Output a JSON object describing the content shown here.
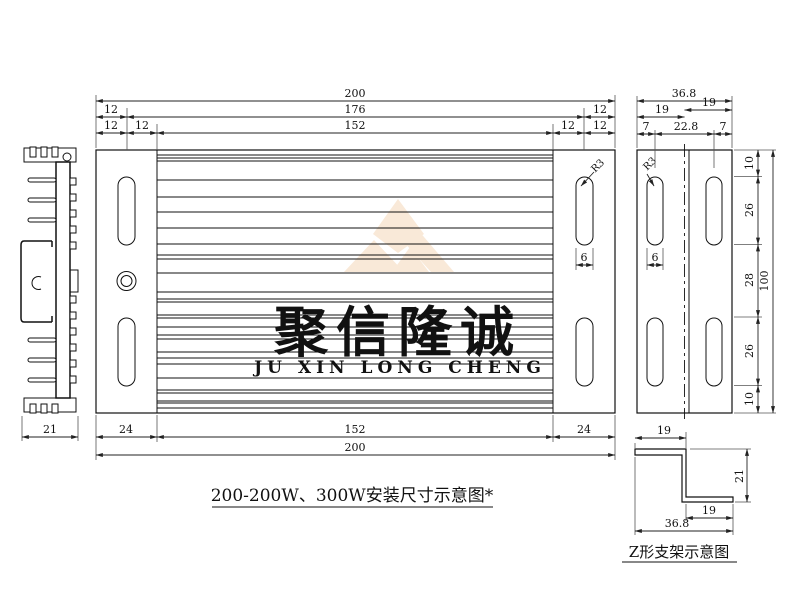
{
  "watermark": {
    "cn": "聚信隆诚",
    "en": "JU XIN LONG CHENG",
    "logo_color": "#f9e9d8",
    "cn_color": "#e3e3e3",
    "en_color": "#f7dcba"
  },
  "captions": {
    "main_title": "200-200W、300W安装尺寸示意图*",
    "bracket_title": "Z形支架示意图"
  },
  "main_view": {
    "dim_overall": "200",
    "dim_inner": "176",
    "dim_slot_span": "152",
    "dim_offset": "12",
    "dim_flange": "24",
    "slot_width": "6",
    "fillet_radius": "R3"
  },
  "side_view": {
    "dim_overall": "36.8",
    "dim_flange_left": "19",
    "dim_flange_right": "19",
    "dim_edge_left": "7",
    "dim_center": "22.8",
    "dim_edge_right": "7",
    "dim_top": "10",
    "dim_upper": "26",
    "dim_middle": "28",
    "dim_lower": "26",
    "dim_bottom": "10",
    "dim_height": "100",
    "slot_width": "6",
    "fillet_radius": "R3"
  },
  "profile_view": {
    "dim_width": "21"
  },
  "bracket_view": {
    "dim_top_leg": "19",
    "dim_height": "21",
    "dim_bottom_leg": "19",
    "dim_overall": "36.8"
  }
}
